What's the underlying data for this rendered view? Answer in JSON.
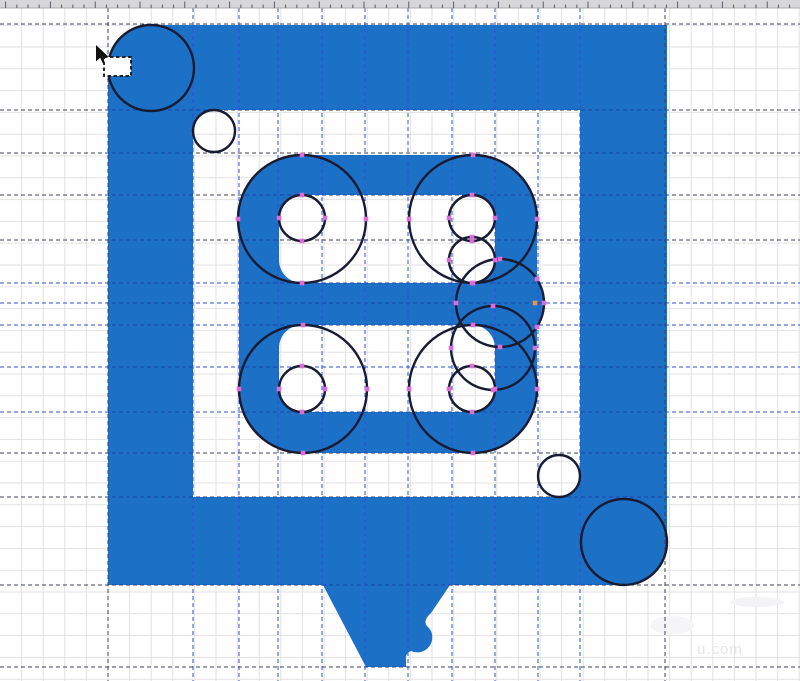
{
  "app": {
    "name": "vector-editor-canvas"
  },
  "canvas": {
    "width": 800,
    "height": 681,
    "background": "#ffffff"
  },
  "colors": {
    "logo_blue": "#1C70C6",
    "construction_stroke": "#191b33",
    "grid": "#e2e2e2",
    "guide_dark": "#3d4358",
    "guide_blue": "#2b50d5",
    "guide_on_logo": "#1d45ad",
    "node_pink": "#de6cd8",
    "node_orange": "#e09a4e",
    "ruler_bg": "#d7d7d9",
    "ruler_tick": "#5a5a66",
    "watermark": "#e4e4ea",
    "cursor_black": "#111111"
  },
  "ruler": {
    "height": 8,
    "minor_step": 11.2,
    "major_every": 4
  },
  "grid": {
    "step_x": 21.6,
    "step_y": 21.8,
    "offset_x": 0,
    "offset_y": 3.4
  },
  "guidelines": {
    "dash": "4 3",
    "vertical": [
      {
        "x": 108,
        "tone": "dark"
      },
      {
        "x": 193,
        "tone": "blue"
      },
      {
        "x": 239,
        "tone": "blue"
      },
      {
        "x": 278,
        "tone": "blue"
      },
      {
        "x": 322,
        "tone": "blue"
      },
      {
        "x": 365,
        "tone": "blue"
      },
      {
        "x": 408,
        "tone": "blue"
      },
      {
        "x": 452,
        "tone": "blue"
      },
      {
        "x": 495,
        "tone": "blue"
      },
      {
        "x": 538,
        "tone": "blue"
      },
      {
        "x": 580,
        "tone": "blue"
      },
      {
        "x": 665,
        "tone": "dark"
      }
    ],
    "horizontal": [
      {
        "y": 24,
        "tone": "dark"
      },
      {
        "y": 110,
        "tone": "dark"
      },
      {
        "y": 153,
        "tone": "dark"
      },
      {
        "y": 195,
        "tone": "dark"
      },
      {
        "y": 240,
        "tone": "dark"
      },
      {
        "y": 283,
        "tone": "blue"
      },
      {
        "y": 303,
        "tone": "blue"
      },
      {
        "y": 325,
        "tone": "blue"
      },
      {
        "y": 367,
        "tone": "blue"
      },
      {
        "y": 412,
        "tone": "blue"
      },
      {
        "y": 453,
        "tone": "dark"
      },
      {
        "y": 497,
        "tone": "dark"
      },
      {
        "y": 585,
        "tone": "dark"
      },
      {
        "y": 667,
        "tone": "dark"
      }
    ]
  },
  "logo": {
    "ring_outer": {
      "x1": 108,
      "y1": 25,
      "x2": 667,
      "y2": 585,
      "r": 43
    },
    "ring_inner": {
      "x1": 193,
      "y1": 110,
      "x2": 580,
      "y2": 497,
      "r": 21
    },
    "b_outer": {
      "x1": 239,
      "y1": 155,
      "x2": 537,
      "y2": 453,
      "r": 64
    },
    "bump": {
      "cx": 500,
      "cy": 303,
      "r": 44
    },
    "hole1": {
      "x1": 279,
      "y1": 195,
      "x2": 495,
      "y2": 283,
      "r": 23
    },
    "hole2": {
      "x1": 279,
      "y1": 325,
      "x2": 495,
      "y2": 412,
      "r": 23
    },
    "tail_d": "M323,585 L450,585 L431,613 Q421,622 429,628 A15,15 0 0 1 411,651 Q405,653 406,660 L406,667 L366,667 Z"
  },
  "construction_circles": [
    {
      "cx": 151,
      "cy": 68,
      "r": 43,
      "nodes": false
    },
    {
      "cx": 214,
      "cy": 131,
      "r": 21,
      "nodes": false
    },
    {
      "cx": 624,
      "cy": 542,
      "r": 43,
      "nodes": false
    },
    {
      "cx": 559,
      "cy": 476,
      "r": 21,
      "nodes": false
    },
    {
      "cx": 302,
      "cy": 219,
      "r": 64,
      "nodes": true
    },
    {
      "cx": 473,
      "cy": 219,
      "r": 64,
      "nodes": true
    },
    {
      "cx": 303,
      "cy": 389,
      "r": 64,
      "nodes": true
    },
    {
      "cx": 473,
      "cy": 389,
      "r": 64,
      "nodes": true
    },
    {
      "cx": 302,
      "cy": 218,
      "r": 23,
      "nodes": true
    },
    {
      "cx": 472,
      "cy": 218,
      "r": 23,
      "nodes": true
    },
    {
      "cx": 472,
      "cy": 260,
      "r": 23,
      "nodes": true
    },
    {
      "cx": 302,
      "cy": 389,
      "r": 23,
      "nodes": true
    },
    {
      "cx": 472,
      "cy": 389,
      "r": 23,
      "nodes": true
    },
    {
      "cx": 500,
      "cy": 303,
      "r": 44,
      "nodes": true
    },
    {
      "cx": 493,
      "cy": 348,
      "r": 42,
      "nodes": true
    }
  ],
  "extra_nodes": {
    "size": 4.6,
    "pink": [
      {
        "x": 537,
        "y": 279
      },
      {
        "x": 537,
        "y": 327
      }
    ],
    "orange": {
      "x": 535,
      "y": 303
    }
  },
  "cursor": {
    "tip_x": 96,
    "tip_y": 45,
    "marquee": {
      "x": 104,
      "y": 57,
      "w": 27,
      "h": 19
    }
  },
  "watermark": {
    "text": "u.com"
  }
}
